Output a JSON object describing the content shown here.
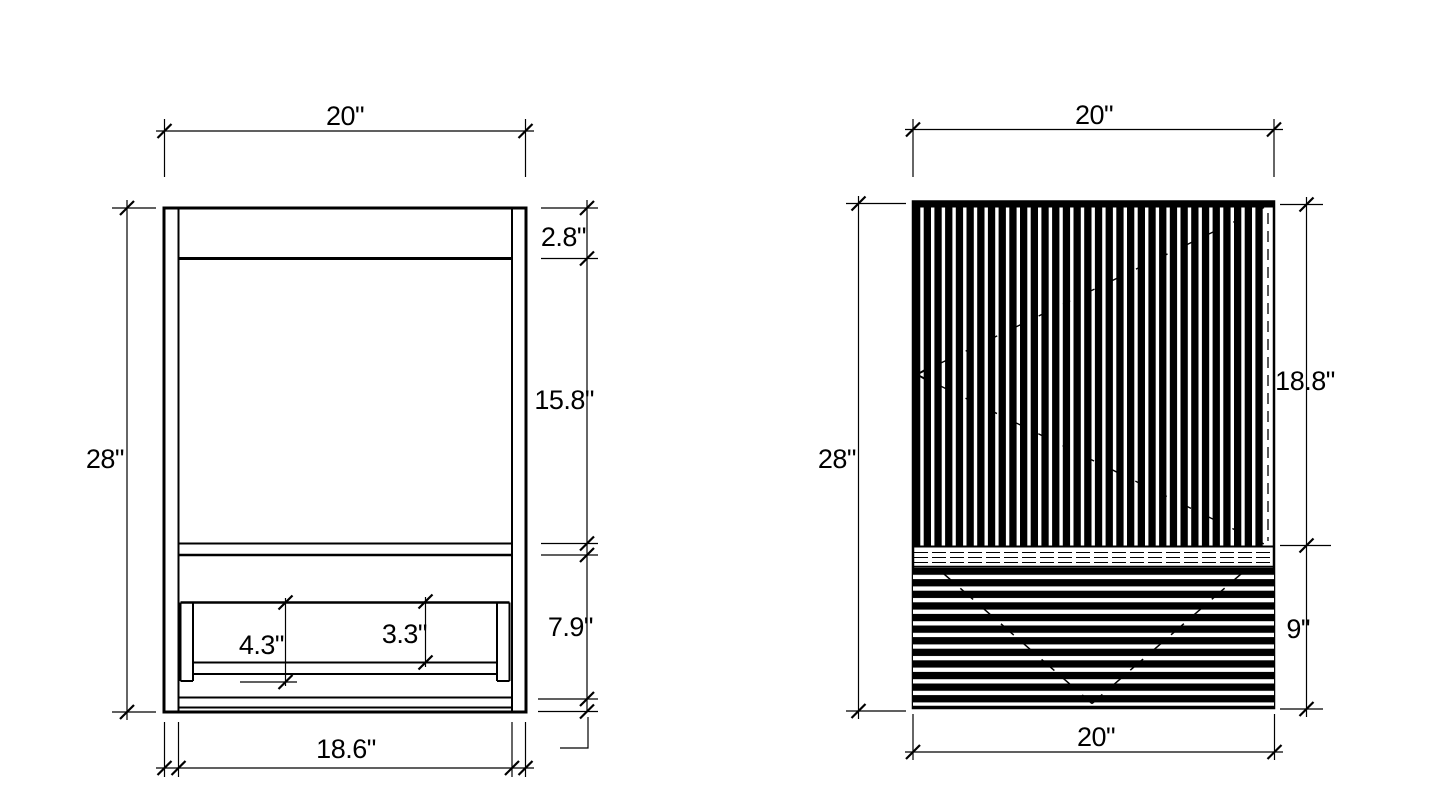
{
  "page": {
    "background_color": "#ffffff",
    "line_color": "#000000"
  },
  "front_view": {
    "description": "cabinet front elevation with open shelf",
    "dimensions": {
      "overall_width": "20\"",
      "overall_height": "28\"",
      "top_rail_height": "2.8\"",
      "opening_height": "15.8\"",
      "base_section_height": "7.9\"",
      "interior_width": "18.6\"",
      "shelf_support_height": "4.3\"",
      "shelf_clearance_height": "3.3\""
    }
  },
  "side_view": {
    "description": "slatted elevation, vertical slats above, horizontal slats below",
    "dimensions": {
      "overall_width": "20\"",
      "overall_height": "28\"",
      "upper_slat_section_height": "18.8\"",
      "lower_slat_section_height": "9\"",
      "base_width": "20\""
    }
  }
}
